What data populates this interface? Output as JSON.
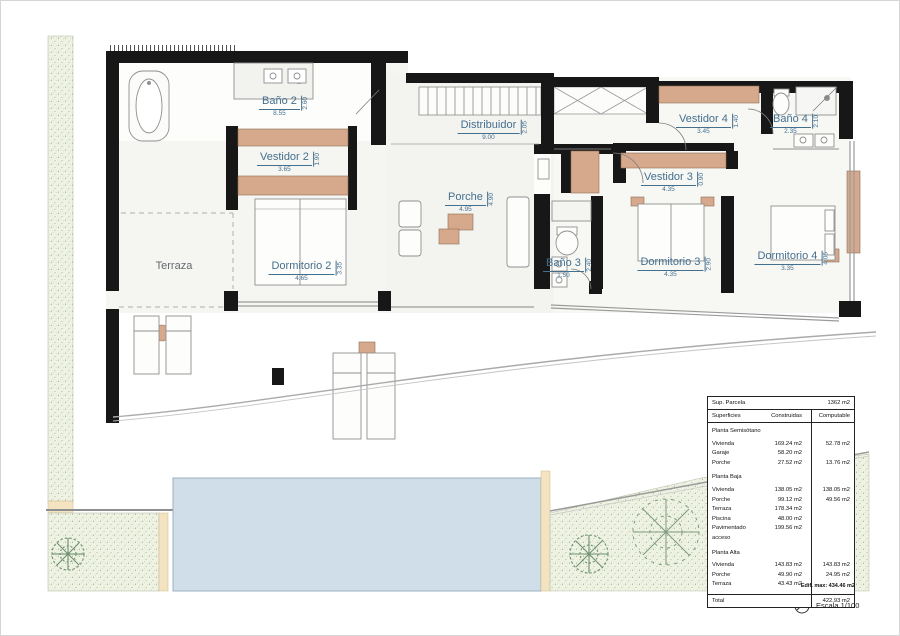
{
  "plan": {
    "rooms": [
      {
        "name": "Baño 2",
        "hdim": "8.55",
        "vdim": "2.60"
      },
      {
        "name": "Vestidor 2",
        "hdim": "3.65",
        "vdim": "1.90"
      },
      {
        "name": "Distribuidor",
        "hdim": "9.00",
        "vdim": "2.05"
      },
      {
        "name": "Porche",
        "hdim": "4.95",
        "vdim": "4.90"
      },
      {
        "name": "Vestidor 4",
        "hdim": "3.45",
        "vdim": "1.40"
      },
      {
        "name": "Baño 4",
        "hdim": "2.35",
        "vdim": "2.10"
      },
      {
        "name": "Vestidor 3",
        "hdim": "4.35",
        "vdim": "0.90"
      },
      {
        "name": "Baño 3",
        "hdim": "1.50",
        "vdim": "2.40"
      },
      {
        "name": "Dormitorio 3",
        "hdim": "4.35",
        "vdim": "2.90"
      },
      {
        "name": "Dormitorio 4",
        "hdim": "3.35",
        "vdim": "4.05"
      },
      {
        "name": "Dormitorio 2",
        "hdim": "4.65",
        "vdim": "3.35"
      },
      {
        "name": "Terraza",
        "hdim": "",
        "vdim": ""
      }
    ]
  },
  "table": {
    "parcel_label": "Sup. Parcela",
    "parcel_value": "1362 m2",
    "col_headers": [
      "Superficies",
      "Construidas",
      "Computable"
    ],
    "sections": [
      {
        "title": "Planta Semisótano",
        "rows": [
          {
            "label": "Vivienda",
            "construidas": "169.24 m2",
            "computable": "52.78 m2"
          },
          {
            "label": "Garaje",
            "construidas": "58.20 m2",
            "computable": ""
          },
          {
            "label": "Porche",
            "construidas": "27.52 m2",
            "computable": "13.76 m2"
          }
        ]
      },
      {
        "title": "Planta Baja",
        "rows": [
          {
            "label": "Vivienda",
            "construidas": "138.05 m2",
            "computable": "138.05 m2"
          },
          {
            "label": "Porche",
            "construidas": "99.12 m2",
            "computable": "49.56 m2"
          },
          {
            "label": "Terraza",
            "construidas": "178.34 m2",
            "computable": ""
          },
          {
            "label": "Piscina",
            "construidas": "48.00 m2",
            "computable": ""
          },
          {
            "label": "Pavimentado acceso",
            "construidas": "199.56 m2",
            "computable": ""
          }
        ]
      },
      {
        "title": "Planta Alta",
        "rows": [
          {
            "label": "Vivienda",
            "construidas": "143.83 m2",
            "computable": "143.83 m2"
          },
          {
            "label": "Porche",
            "construidas": "49.90 m2",
            "computable": "24.95 m2"
          },
          {
            "label": "Terraza",
            "construidas": "43.43 m2",
            "computable": ""
          }
        ]
      }
    ],
    "total_label": "Total",
    "total_value": "422.93 m2",
    "note": "Edif. max: 434.46 m2"
  },
  "footer": {
    "scale_label": "Escala 1/100"
  },
  "colors": {
    "wall": "#171717",
    "wardrobe": "#d7a98c",
    "label_blue": "#44708f",
    "pool": "#cfdee9",
    "vegetation": "#eef2e3",
    "paving": "#f4e3c1"
  }
}
